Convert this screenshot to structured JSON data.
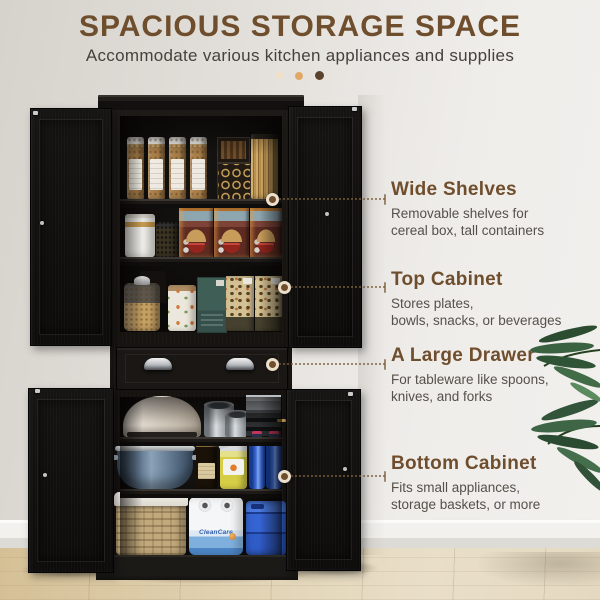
{
  "header": {
    "title": "SPACIOUS STORAGE SPACE",
    "subtitle": "Accommodate various kitchen appliances and supplies"
  },
  "callouts": [
    {
      "title": "Wide Shelves",
      "desc": "Removable shelves for\ncereal box, tall containers"
    },
    {
      "title": "Top Cabinet",
      "desc": "Stores plates,\nbowls, snacks, or beverages"
    },
    {
      "title": "A Large Drawer",
      "desc": "For tableware like spoons,\nknives, and forks"
    },
    {
      "title": "Bottom Cabinet",
      "desc": "Fits small appliances,\nstorage baskets, or more"
    }
  ],
  "product_labels": {
    "paper_towels": "CleanCare"
  },
  "colors": {
    "title-brown": "#6f4e2d",
    "text-dark": "#46413c",
    "text-gray": "#55504a",
    "leader-brown": "#7d5f3c",
    "dot-light": "#f0dfc6",
    "dot-mid": "#dfa868",
    "dot-dark": "#5a432b",
    "cabinet-black": "#15120f",
    "wall-gray": "#e2dfda",
    "floor-tan": "#ddcfae",
    "plant-green": "#35573a"
  }
}
